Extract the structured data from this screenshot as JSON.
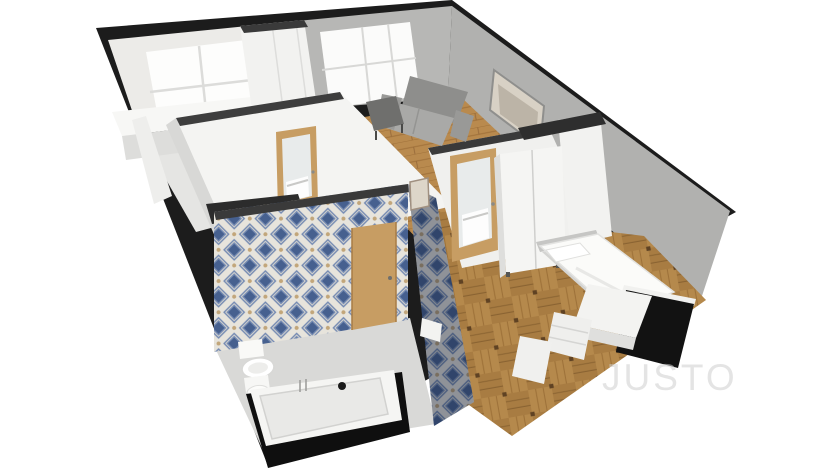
{
  "image": {
    "type": "3d-floorplan-render",
    "width": 832,
    "height": 468
  },
  "watermark": {
    "text": "JUSTO",
    "color": "#cfcfcf"
  },
  "rooms": [
    "kitchen",
    "living-room",
    "hallway",
    "bathroom",
    "bedroom"
  ],
  "palette": {
    "background": "#ffffff",
    "wallCut": "#1c1c1c",
    "wallCap": "#3a3a3a",
    "wallWhite": "#f4f4f2",
    "wallGray": "#b1b1af",
    "wallGrayMid": "#b7b7b5",
    "kitchenWallWhite": "#ecebe8",
    "floorKitchen": "#e5e5e3",
    "floorBath": "#d9d9d7",
    "woodHall": "#b98a4e",
    "woodParquet": "#a87c42",
    "tileBg": "#e7e4dc",
    "tileBlue": "#7389b2",
    "tileNavy": "#46608f",
    "tileAccent": "#c2a67a",
    "doorWood": "#c79d63",
    "mirror": "#e8ebeb",
    "sofaGray": "#8e8e8c",
    "sofaSeat": "#a9a9a7",
    "furnitureBlack": "#121212",
    "fixtureWhite": "#f5f5f3"
  }
}
